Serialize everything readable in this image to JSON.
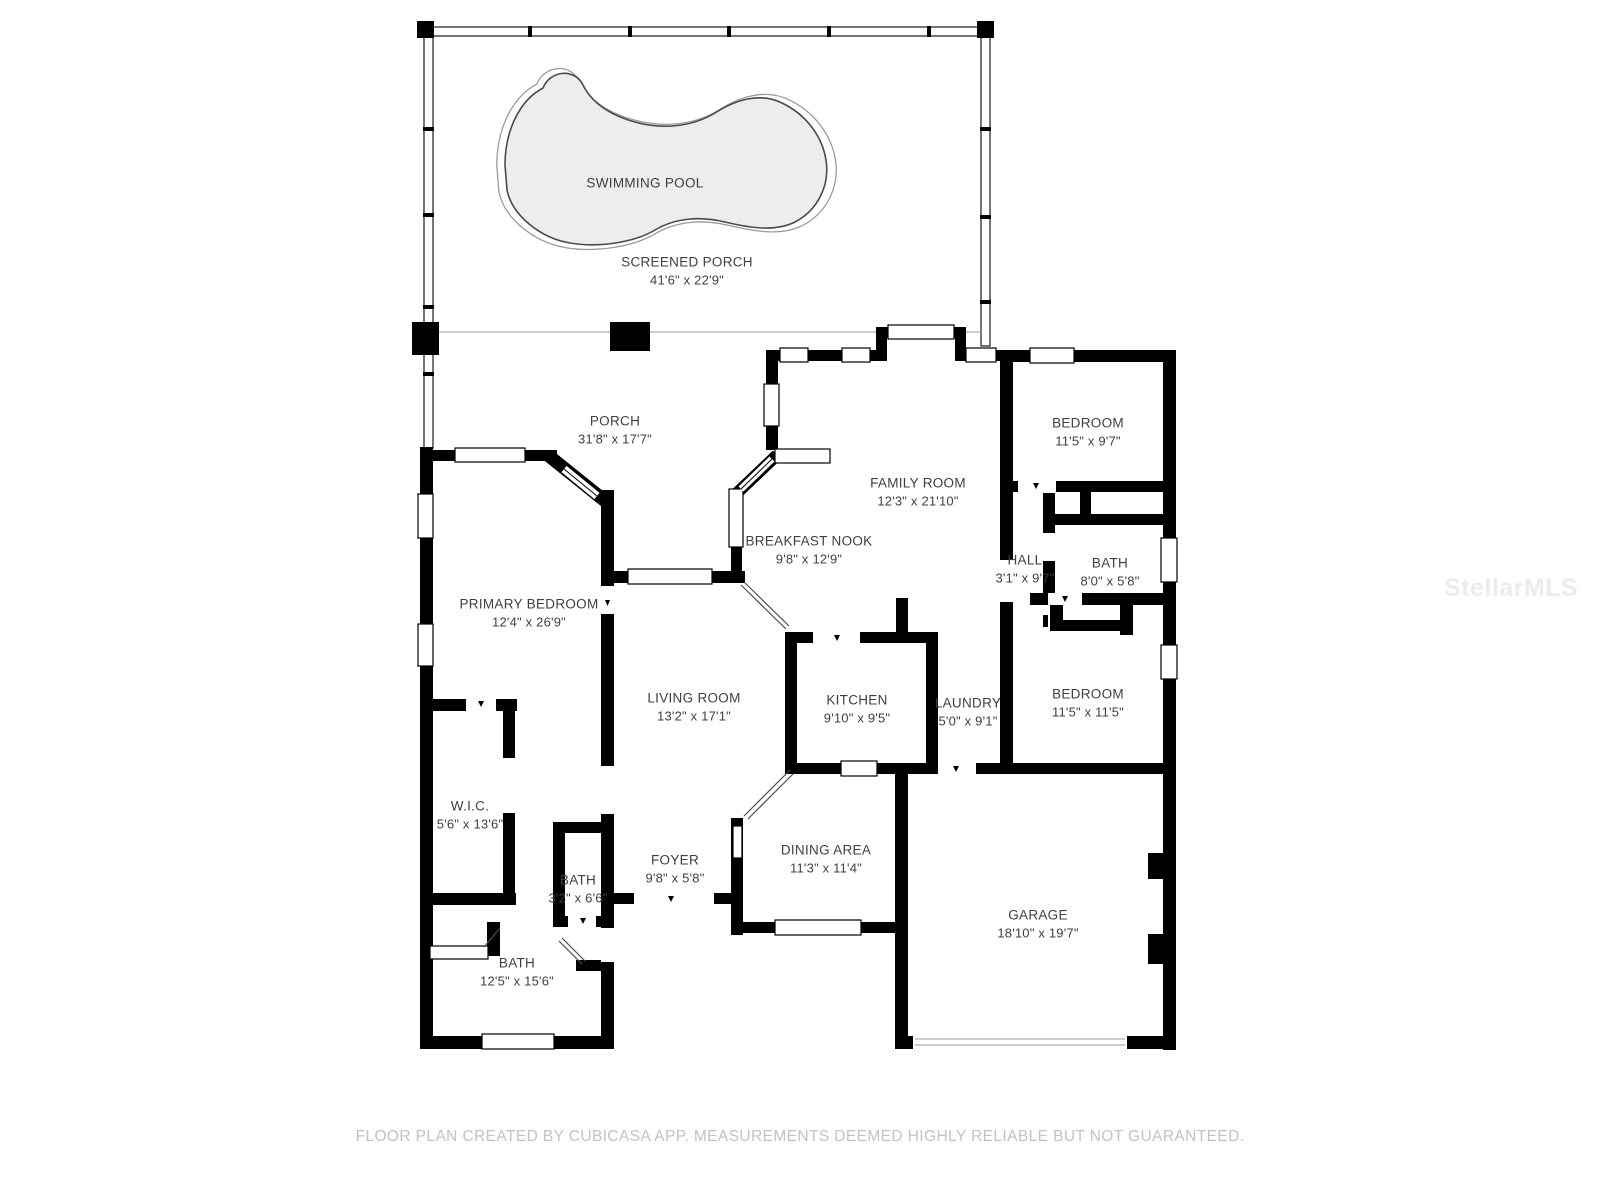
{
  "colors": {
    "wall": "#000000",
    "pool_fill": "#ededed",
    "label_text": "#3f3f3f",
    "footer_text": "#c2c2c2",
    "watermark_text": "#ececec"
  },
  "rooms": {
    "swimming_pool": {
      "label": "SWIMMING POOL",
      "dims": ""
    },
    "screened_porch": {
      "label": "SCREENED PORCH",
      "dims": "41'6\" x 22'9\""
    },
    "porch": {
      "label": "PORCH",
      "dims": "31'8\" x 17'7\""
    },
    "family_room": {
      "label": "FAMILY ROOM",
      "dims": "12'3\" x 21'10\""
    },
    "bedroom_top": {
      "label": "BEDROOM",
      "dims": "11'5\" x 9'7\""
    },
    "breakfast_nook": {
      "label": "BREAKFAST NOOK",
      "dims": "9'8\" x 12'9\""
    },
    "hall": {
      "label": "HALL",
      "dims": "3'1\" x 9'7\""
    },
    "bath_right": {
      "label": "BATH",
      "dims": "8'0\" x 5'8\""
    },
    "primary_bedroom": {
      "label": "PRIMARY BEDROOM",
      "dims": "12'4\" x 26'9\""
    },
    "living_room": {
      "label": "LIVING ROOM",
      "dims": "13'2\" x 17'1\""
    },
    "kitchen": {
      "label": "KITCHEN",
      "dims": "9'10\" x 9'5\""
    },
    "laundry": {
      "label": "LAUNDRY",
      "dims": "5'0\" x 9'1\""
    },
    "bedroom_right": {
      "label": "BEDROOM",
      "dims": "11'5\" x 11'5\""
    },
    "wic": {
      "label": "W.I.C.",
      "dims": "5'6\" x 13'6\""
    },
    "foyer": {
      "label": "FOYER",
      "dims": "9'8\" x 5'8\""
    },
    "bath_small": {
      "label": "BATH",
      "dims": "3'2\" x 6'6\""
    },
    "dining_area": {
      "label": "DINING AREA",
      "dims": "11'3\" x 11'4\""
    },
    "garage": {
      "label": "GARAGE",
      "dims": "18'10\" x 19'7\""
    },
    "bath_lower": {
      "label": "BATH",
      "dims": "12'5\" x 15'6\""
    }
  },
  "footer": "FLOOR PLAN CREATED BY CUBICASA APP. MEASUREMENTS DEEMED HIGHLY RELIABLE BUT NOT GUARANTEED.",
  "watermark": "StellarMLS"
}
